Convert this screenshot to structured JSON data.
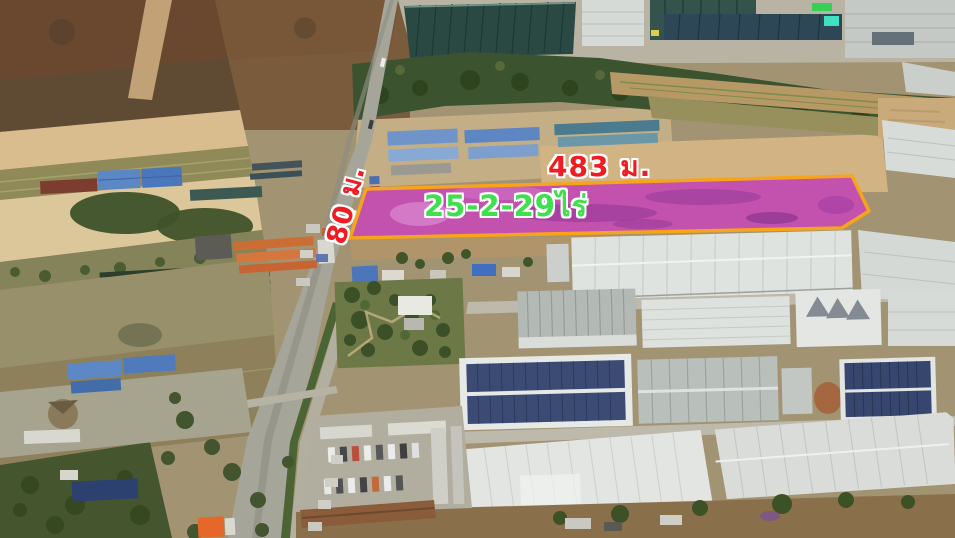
{
  "annotations": {
    "width_label": {
      "text": "483 ม.",
      "color": "#ef1c23",
      "outline_color": "#ffffff"
    },
    "depth_label": {
      "text": "80 ม.",
      "color": "#ef1c23",
      "outline_color": "#ffffff"
    },
    "area_label": {
      "text": "25-2-29ไร่",
      "color": "#3fdf4d",
      "outline_color": "#ffffff"
    },
    "plot": {
      "fill_color": "#c02ec4",
      "border_color": "#f7a41d"
    }
  }
}
